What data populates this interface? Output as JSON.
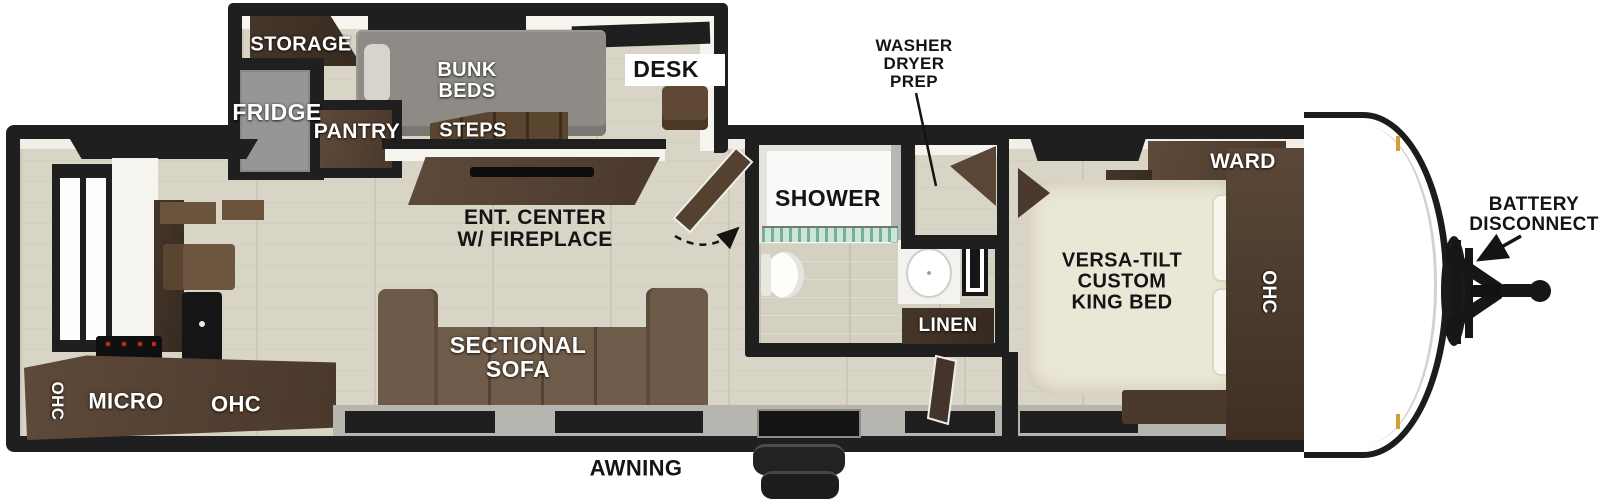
{
  "diagram": {
    "type": "travel-trailer-floorplan",
    "rooms": {
      "bunk_room": {
        "storage": "STORAGE",
        "bunk_beds": [
          "BUNK",
          "BEDS"
        ],
        "desk": "DESK",
        "fridge": "FRIDGE",
        "pantry": "PANTRY",
        "steps": "STEPS"
      },
      "living_area": {
        "ent_center": [
          "ENT. CENTER",
          "W/ FIREPLACE"
        ],
        "sofa": [
          "SECTIONAL",
          "SOFA"
        ]
      },
      "kitchen": {
        "ohc_left": "OHC",
        "micro": "MICRO",
        "ohc_right": "OHC"
      },
      "bathroom": {
        "shower": "SHOWER",
        "linen": "LINEN",
        "washer_dryer_prep": [
          "WASHER",
          "DRYER",
          "PREP"
        ]
      },
      "bedroom": {
        "king_bed": [
          "VERSA-TILT",
          "CUSTOM",
          "KING BED"
        ],
        "ward": "WARD",
        "ohc": "OHC"
      },
      "exterior": {
        "awning": "AWNING",
        "battery_disconnect": [
          "BATTERY",
          "DISCONNECT"
        ]
      }
    },
    "colors": {
      "wall": "#1f1f1f",
      "floor": "#d9d5c6",
      "cabinet_wood": "#53402f",
      "cabinet_dark": "#3b2d22",
      "sofa_brown": "#6e5a48",
      "mattress_cream": "#ebe7d6",
      "appliance_gray": "#989694",
      "bunk_gray": "#8e8b86",
      "shower_glass_teal": "#c9e6d6",
      "accent_gold": "#d2a12e",
      "label_white": "#ffffff",
      "label_black": "#141414"
    }
  }
}
